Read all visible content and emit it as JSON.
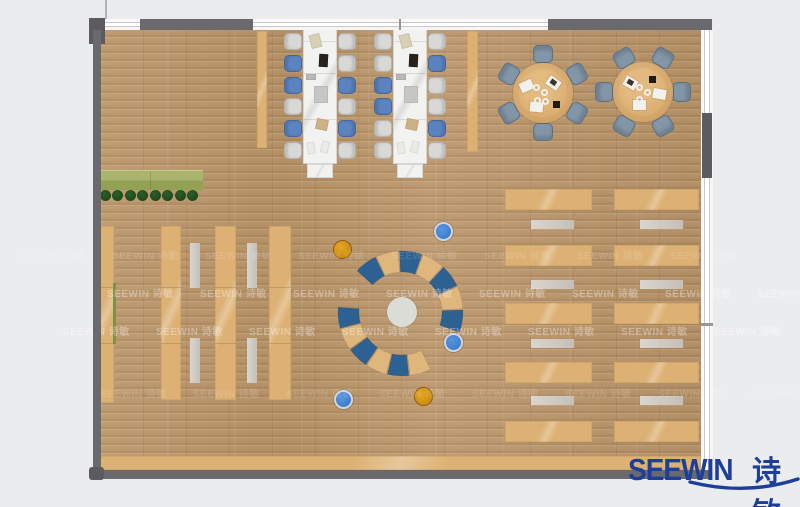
{
  "canvas": {
    "w": 800,
    "h": 507
  },
  "palette": {
    "background": "#ebecee",
    "floor_base": "#c0996c",
    "wall": "#6a6a6e",
    "wall_dark": "#5c5c60",
    "wood_furniture": "#ddb174",
    "bench_gray": "#cdc7be",
    "desk_white": "#f2f2f0",
    "chair_gray": "#d8d9d7",
    "chair_gray_border": "#b3b4b2",
    "chair_blue": "#5b83bf",
    "chair_blue_border": "#45689c",
    "chair_slate": "#8296a8",
    "chair_slate_border": "#5e7283",
    "table_wood": "#d9aa6c",
    "planter_top": "#aab46d",
    "planter_bottom": "#93a155",
    "plant_green": "#1d4a1c",
    "arc_blue": "#2d6191",
    "arc_wood": "#dfb67c",
    "center_circle": "#dbdbd8",
    "stool_orange": "#cd8d12",
    "stool_orange_ring": "#8a5f0e",
    "stool_blue": "#3d7ed2",
    "stool_blue_ring": "#d0d4d8",
    "logo_blue": "#1d3e9a"
  },
  "logo": {
    "brand": "SEEWIN",
    "brand_cn": "诗敏"
  },
  "watermark": {
    "text": "SEEWIN 诗敏",
    "step": 93,
    "count": 8,
    "rows": [
      {
        "y": 247,
        "x0": 19,
        "alpha": 0.13
      },
      {
        "y": 285,
        "x0": 107,
        "alpha": 0.32
      },
      {
        "y": 323,
        "x0": 63,
        "alpha": 0.32
      },
      {
        "y": 385,
        "x0": 100,
        "alpha": 0.13
      }
    ]
  },
  "structure": [
    {
      "n": "door-gap-top",
      "x": 105,
      "y": 19,
      "w": 35,
      "h": 11,
      "t": "winh"
    },
    {
      "n": "wall-top-left",
      "x": 140,
      "y": 19,
      "w": 113,
      "h": 11,
      "t": "wall"
    },
    {
      "n": "window-top",
      "x": 253,
      "y": 19,
      "w": 295,
      "h": 11,
      "t": "winh"
    },
    {
      "n": "window-top-mullion",
      "x": 399,
      "y": 19,
      "w": 2,
      "h": 11,
      "t": "mullion"
    },
    {
      "n": "wall-top-right",
      "x": 548,
      "y": 19,
      "w": 164,
      "h": 11,
      "t": "wall"
    },
    {
      "n": "column-top-left",
      "x": 89,
      "y": 18,
      "w": 16,
      "h": 26,
      "t": "wall-dark"
    },
    {
      "n": "wall-left",
      "x": 93,
      "y": 30,
      "w": 8,
      "h": 448,
      "t": "wall"
    },
    {
      "n": "window-right",
      "x": 701,
      "y": 30,
      "w": 12,
      "h": 440,
      "t": "winv"
    },
    {
      "n": "wall-right-solid",
      "x": 702,
      "y": 113,
      "w": 10,
      "h": 65,
      "t": "wall-dark"
    },
    {
      "n": "window-right-divider",
      "x": 701,
      "y": 323,
      "w": 12,
      "h": 3,
      "t": "mullion"
    },
    {
      "n": "wall-bottom",
      "x": 93,
      "y": 470,
      "w": 619,
      "h": 9,
      "t": "wall"
    },
    {
      "n": "column-bottom-left",
      "x": 89,
      "y": 467,
      "w": 15,
      "h": 13,
      "t": "wall-dark",
      "r": 3
    },
    {
      "n": "top-thin-line",
      "x": 105,
      "y": 0,
      "w": 2,
      "h": 19,
      "t": "thinline"
    }
  ],
  "furniture": {
    "planter": {
      "x": 100,
      "y": 170,
      "w": 103,
      "h": 19,
      "seam_x": 50
    },
    "plants": {
      "cy": 195,
      "r": 5.5,
      "cx": [
        105,
        117.5,
        130,
        142.5,
        155,
        167.5,
        180,
        192.5
      ]
    },
    "shelf_strips": [
      {
        "x": 98,
        "y": 226,
        "w": 16,
        "h": 177
      },
      {
        "x": 161,
        "y": 226,
        "w": 20,
        "h": 174
      },
      {
        "x": 215,
        "y": 226,
        "w": 21,
        "h": 174
      },
      {
        "x": 269,
        "y": 226,
        "w": 22,
        "h": 174
      }
    ],
    "strip_seams": [
      61,
      117
    ],
    "green_sliver": {
      "x": 113,
      "y": 283,
      "w": 3,
      "h": 61,
      "c": "#7d9148"
    },
    "shelf_benches": [
      {
        "x": 190,
        "y": 243,
        "w": 10,
        "h": 45
      },
      {
        "x": 190,
        "y": 338,
        "w": 10,
        "h": 45
      },
      {
        "x": 247,
        "y": 243,
        "w": 10,
        "h": 45
      },
      {
        "x": 247,
        "y": 338,
        "w": 10,
        "h": 45
      }
    ],
    "pillars": [
      {
        "x": 257,
        "y": 31,
        "w": 10,
        "h": 117
      },
      {
        "x": 467,
        "y": 31,
        "w": 11,
        "h": 121
      }
    ],
    "bottom_counter": {
      "x": 100,
      "y": 456,
      "w": 601,
      "h": 14
    },
    "reading_tables": {
      "columns": [
        {
          "x": 505,
          "w": 87,
          "bench_x": 531,
          "bench_w": 43
        },
        {
          "x": 614,
          "w": 85,
          "bench_x": 640,
          "bench_w": 43
        }
      ],
      "table_y": [
        189,
        245,
        303,
        362,
        421
      ],
      "table_h": 21,
      "bench_y": [
        220,
        280,
        339,
        396
      ],
      "bench_h": 9
    },
    "desk_clusters": {
      "spine_w": 34,
      "spine_h": 137,
      "cap": {
        "dx": 4,
        "dy": 137,
        "w": 26,
        "h": 14
      },
      "seams_dy": [
        13,
        45,
        91
      ],
      "chair": {
        "w": 18,
        "h": 17
      },
      "chair_dy": [
        6,
        28,
        50,
        71,
        93,
        115
      ],
      "clusters": [
        {
          "x": 303,
          "y": 27,
          "left": [
            "gray",
            "blue",
            "blue",
            "gray",
            "blue",
            "gray"
          ],
          "right": [
            "gray",
            "gray",
            "blue",
            "gray",
            "blue",
            "gray"
          ]
        },
        {
          "x": 393,
          "y": 27,
          "left": [
            "gray",
            "gray",
            "blue",
            "blue",
            "gray",
            "gray"
          ],
          "right": [
            "gray",
            "blue",
            "gray",
            "gray",
            "blue",
            "gray"
          ]
        }
      ],
      "items": [
        {
          "dx": 7,
          "dy": 7,
          "w": 11,
          "h": 14,
          "c": "#d8d0b4",
          "rot": -14
        },
        {
          "dx": 16,
          "dy": 27,
          "w": 9,
          "h": 13,
          "c": "#26221d",
          "rot": 3
        },
        {
          "dx": 3,
          "dy": 47,
          "w": 10,
          "h": 6,
          "c": "#b8b8b4",
          "rot": 0
        },
        {
          "dx": 11,
          "dy": 59,
          "w": 14,
          "h": 17,
          "c": "#c6c6c3",
          "rot": 0
        },
        {
          "dx": 13,
          "dy": 92,
          "w": 12,
          "h": 11,
          "c": "#cdb187",
          "rot": 12
        },
        {
          "dx": 4,
          "dy": 115,
          "w": 8,
          "h": 12,
          "c": "#eceae4",
          "rot": -10
        },
        {
          "dx": 18,
          "dy": 114,
          "w": 8,
          "h": 12,
          "c": "#eceae4",
          "rot": 14
        }
      ]
    },
    "round_tables": {
      "chair": {
        "w": 20,
        "h": 18,
        "dist": 39
      },
      "paper": {
        "w": 13,
        "h": 10
      },
      "tables": [
        {
          "cx": 543,
          "cy": 93,
          "r": 30,
          "chair_angles": [
            270,
            330,
            30,
            90,
            150,
            210
          ],
          "papers": [
            {
              "dx": 10,
              "dy": -10,
              "rot": 35,
              "img": true
            },
            {
              "dx": -17,
              "dy": -7,
              "rot": -25,
              "img": false
            },
            {
              "dx": -7,
              "dy": 14,
              "rot": 5,
              "img": false
            }
          ],
          "donuts": [
            [
              -7,
              -6
            ],
            [
              1,
              -1
            ],
            [
              -6,
              7
            ],
            [
              2,
              8
            ]
          ],
          "dark": [
            13,
            11
          ]
        },
        {
          "cx": 643,
          "cy": 92,
          "r": 30,
          "chair_angles": [
            0,
            60,
            120,
            180,
            240,
            300
          ],
          "papers": [
            {
              "dx": -13,
              "dy": -9,
              "rot": 30,
              "img": true
            },
            {
              "dx": 16,
              "dy": 2,
              "rot": 10,
              "img": false
            },
            {
              "dx": -4,
              "dy": 13,
              "rot": 0,
              "img": false
            }
          ],
          "donuts": [
            [
              -4,
              -5
            ],
            [
              4,
              0
            ],
            [
              -4,
              7
            ]
          ],
          "dark": [
            9,
            -13
          ]
        }
      ]
    },
    "amphitheater": {
      "cx": 402,
      "cy": 312,
      "inner_r": 15,
      "arcs": [
        {
          "r_in": 40,
          "r_out": 61,
          "segments": [
            {
              "a0": 222,
              "a1": 244.6,
              "c": "blue"
            },
            {
              "a0": 244.6,
              "a1": 267.1,
              "c": "wood"
            },
            {
              "a0": 267.1,
              "a1": 289.7,
              "c": "blue"
            },
            {
              "a0": 289.7,
              "a1": 312.3,
              "c": "wood"
            },
            {
              "a0": 312.3,
              "a1": 334.9,
              "c": "blue"
            },
            {
              "a0": 334.9,
              "a1": 357.4,
              "c": "wood"
            },
            {
              "a0": 357.4,
              "a1": 380,
              "c": "blue"
            }
          ]
        },
        {
          "r_in": 43,
          "r_out": 64,
          "segments": [
            {
              "a0": 185,
              "a1": 164.7,
              "c": "blue"
            },
            {
              "a0": 164.7,
              "a1": 144.3,
              "c": "wood"
            },
            {
              "a0": 144.3,
              "a1": 124,
              "c": "blue"
            },
            {
              "a0": 124,
              "a1": 103.7,
              "c": "wood"
            },
            {
              "a0": 103.7,
              "a1": 83.3,
              "c": "blue"
            },
            {
              "a0": 83.3,
              "a1": 63,
              "c": "wood"
            }
          ]
        }
      ]
    },
    "stools": {
      "r": 9.5,
      "list": [
        {
          "cx": 342,
          "cy": 249,
          "t": "orange"
        },
        {
          "cx": 443,
          "cy": 231,
          "t": "blue"
        },
        {
          "cx": 453,
          "cy": 342,
          "t": "blue"
        },
        {
          "cx": 343,
          "cy": 399,
          "t": "blue"
        },
        {
          "cx": 423,
          "cy": 396,
          "t": "orange"
        }
      ]
    }
  }
}
